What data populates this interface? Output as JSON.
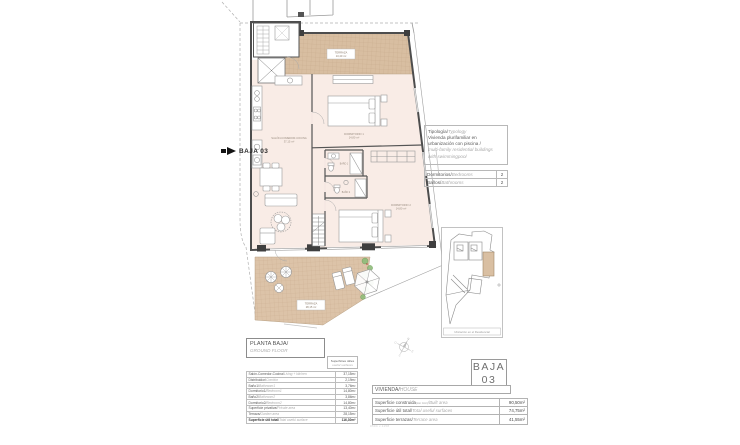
{
  "arrow_label": "BAJA 03",
  "typology": {
    "title_es": "Tipología/",
    "title_en": "Typology",
    "line1_es": "Vivienda plurifamiliar en",
    "line2_es": "urbanización con piscina /",
    "line3_en": "multi-family residential buildings",
    "line4_en": "with swimmingpool"
  },
  "features": [
    {
      "es": "Dormitorios/",
      "en": "Bedrooms",
      "value": "2"
    },
    {
      "es": "Baños/",
      "en": "Bathrooms",
      "value": "2"
    }
  ],
  "planta": {
    "es": "PLANTA BAJA/",
    "en": "GROUND FLOOR"
  },
  "useful": {
    "es": "Superficies útiles",
    "en": "useful surfaces"
  },
  "areas": [
    {
      "es": "Salón-Comedor-Cocina/",
      "en": "Living + kitchen",
      "value": "37,15m²"
    },
    {
      "es": "Distribuidor/",
      "en": "Corridor",
      "value": "2,19m²"
    },
    {
      "es": "Baño1/",
      "en": "Bathroom1",
      "value": "3,76m²"
    },
    {
      "es": "Dormitorio1/",
      "en": "Bedroom1",
      "value": "14,80m²"
    },
    {
      "es": "Baño2/",
      "en": "Bathroom2",
      "value": "3,86m²"
    },
    {
      "es": "Dormitorio2/",
      "en": "Bedroom2",
      "value": "14,80m²"
    },
    {
      "es": "Superficie privativa/",
      "en": "Private area",
      "value": "13,40m²"
    },
    {
      "es": "Terraza/",
      "en": "Garden area",
      "value": "28,15m²"
    },
    {
      "es": "Superficie útil total/",
      "en": "Total useful surface",
      "value": "116,30m²"
    }
  ],
  "vivienda": {
    "es": "VIVIENDA/",
    "en": "HOUSE"
  },
  "baja_badge": {
    "line1": "BAJA",
    "line2": "03"
  },
  "totals": [
    {
      "es": "Superficie construida",
      "note": "(con zzcc)",
      "en": "/Built area",
      "value": "90,50m²"
    },
    {
      "es": "Superficie útil total/",
      "note": "",
      "en": "Total useful surfaces",
      "value": "74,75m²"
    },
    {
      "es": "Superficie terrazas/",
      "note": "",
      "en": "Terrace area",
      "value": "41,55m²"
    }
  ],
  "site": {
    "caption": "Ubicación en el Residencial"
  },
  "compass": {
    "n": "N",
    "s": "S",
    "e": "E",
    "o": "O"
  },
  "fine_print": "0504 v.1158",
  "plan_labels": {
    "salon": "SALÓN-COMEDOR-COCINA",
    "salon_area": "37,15 m²",
    "dorm1": "DORMITORIO 1",
    "dorm1_area": "14,80 m²",
    "dorm2": "DORMITORIO 2",
    "dorm2_area": "14,80 m²",
    "bano1": "BAÑO 1",
    "bano2": "BAÑO 2",
    "terr_up": "TERRAZA",
    "terr_up_area": "13,40 m²",
    "terr_low": "TERRAZA",
    "terr_low_area": "28,15 m²"
  },
  "colors": {
    "terrace_tile": "#d9bfa2",
    "interior_fill": "#f9ece6",
    "wall": "#4d4d4d",
    "vegetation": "#6a9e55",
    "accent_red": "#b0443a"
  }
}
